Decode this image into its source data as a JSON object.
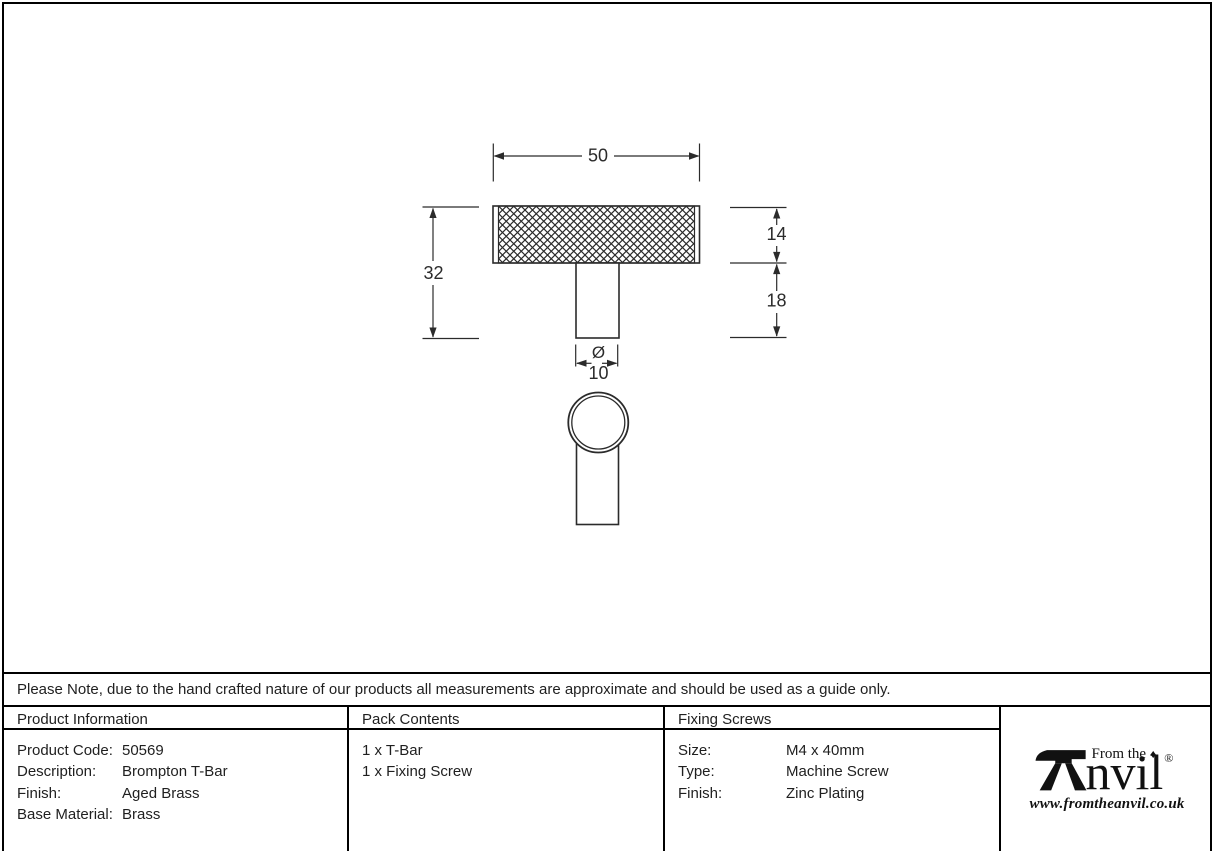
{
  "drawing": {
    "dim_width": "50",
    "dim_overall_height": "32",
    "dim_head_height": "14",
    "dim_stem_height": "18",
    "dim_diameter_symbol": "Ø",
    "dim_diameter": "10"
  },
  "note": "Please Note, due to the hand crafted nature of our products all measurements are approximate and should be used as a guide only.",
  "tables": {
    "product_information": {
      "title": "Product Information",
      "rows": [
        {
          "label": "Product Code:",
          "value": "50569"
        },
        {
          "label": "Description:",
          "value": "Brompton T-Bar"
        },
        {
          "label": "Finish:",
          "value": "Aged Brass"
        },
        {
          "label": "Base Material:",
          "value": "Brass"
        }
      ]
    },
    "pack_contents": {
      "title": "Pack Contents",
      "items": [
        "1 x T-Bar",
        "1 x Fixing Screw"
      ]
    },
    "fixing_screws": {
      "title": "Fixing Screws",
      "rows": [
        {
          "label": "Size:",
          "value": "M4 x 40mm"
        },
        {
          "label": "Type:",
          "value": "Machine Screw"
        },
        {
          "label": "Finish:",
          "value": "Zinc Plating"
        }
      ]
    }
  },
  "logo": {
    "prefix": "From the",
    "diamond": "♦",
    "name_rest": "nvil",
    "registered": "®",
    "website": "www.fromtheanvil.co.uk"
  }
}
